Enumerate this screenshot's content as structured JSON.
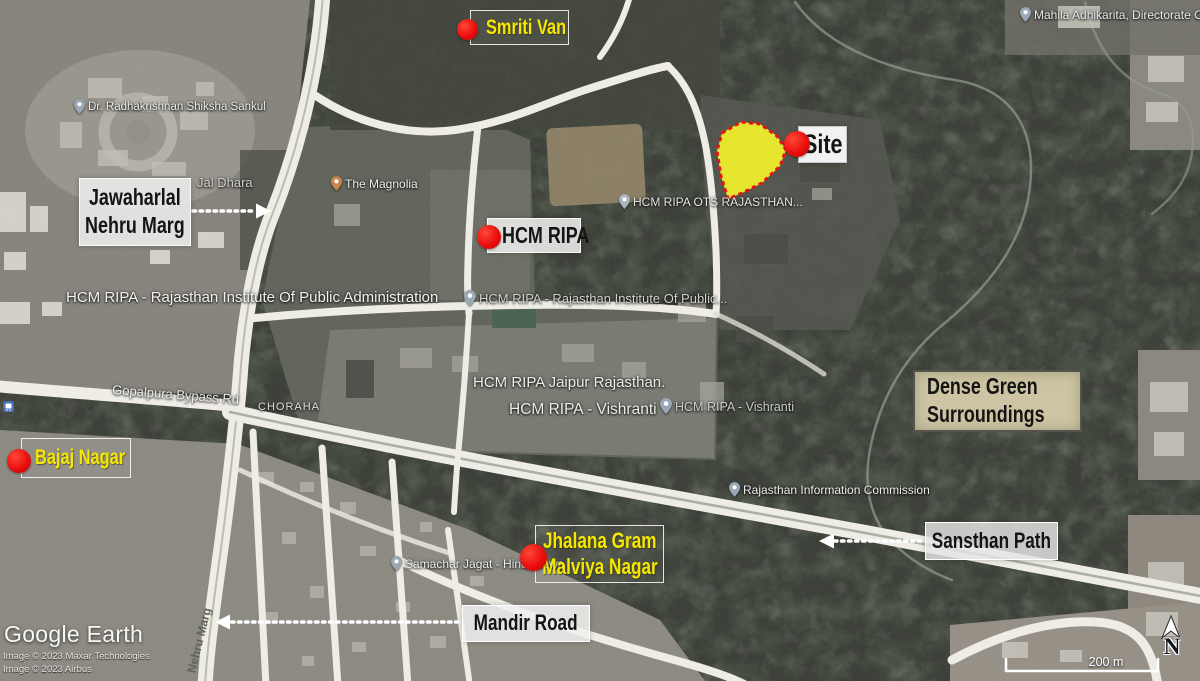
{
  "annotations": {
    "smriti_van": {
      "label": "Smriti Van"
    },
    "site": {
      "label": "Site"
    },
    "hcm_ripa": {
      "label": "HCM RIPA"
    },
    "jawaharlal": {
      "line1": "Jawaharlal",
      "line2": "Nehru Marg"
    },
    "bajaj_nagar": {
      "label": "Bajaj Nagar"
    },
    "jhalana": {
      "line1": "Jhalana Gram",
      "line2": "Malviya Nagar"
    },
    "dense_green": {
      "line1": "Dense Green",
      "line2": "Surroundings"
    },
    "sansthan_path": {
      "label": "Sansthan Path"
    },
    "mandir_road": {
      "label": "Mandir Road"
    }
  },
  "map_labels": {
    "radhakrishnan": "Dr. Radhakrishnan Shiksha Sankul",
    "jal_dhara": "Jal Dhara",
    "magnolia": "The Magnolia",
    "hcm_ots": "HCM RIPA OTS RAJASTHAN...",
    "hcm_full": "HCM RIPA - Rajasthan Institute Of Public Administration",
    "hcm_partial": "HCM RIPA - Rajasthan Institute Of Public...",
    "hcm_jaipur": "HCM RIPA Jaipur Rajasthan.",
    "vishranti": "HCM RIPA - Vishranti",
    "vishranti_small": "HCM RIPA - Vishranti",
    "rajasthan_info": "Rajasthan Information Commission",
    "mahila": "Mahila Adhikarita, Directorate Of...",
    "samachar": "Samachar Jagat - Hindi News",
    "gopalpura": "Gopalpura Bypass Rd",
    "chorha": "CHORAHA",
    "nehru_marg_road": "Nehru Marg"
  },
  "attribution": {
    "logo": "Google Earth",
    "credit1": "Image © 2023 Maxar Technologies",
    "credit2": "Image © 2023 Airbus"
  },
  "scale_bar": {
    "label": "200 m"
  },
  "compass": {
    "label": "N"
  },
  "colors": {
    "site_fill": "#e6e62e",
    "site_border": "#e81111",
    "marker_red": "#e30d0d",
    "annotation_yellow": "#f6e700",
    "dense_box_bg": "#ccc4a2"
  }
}
